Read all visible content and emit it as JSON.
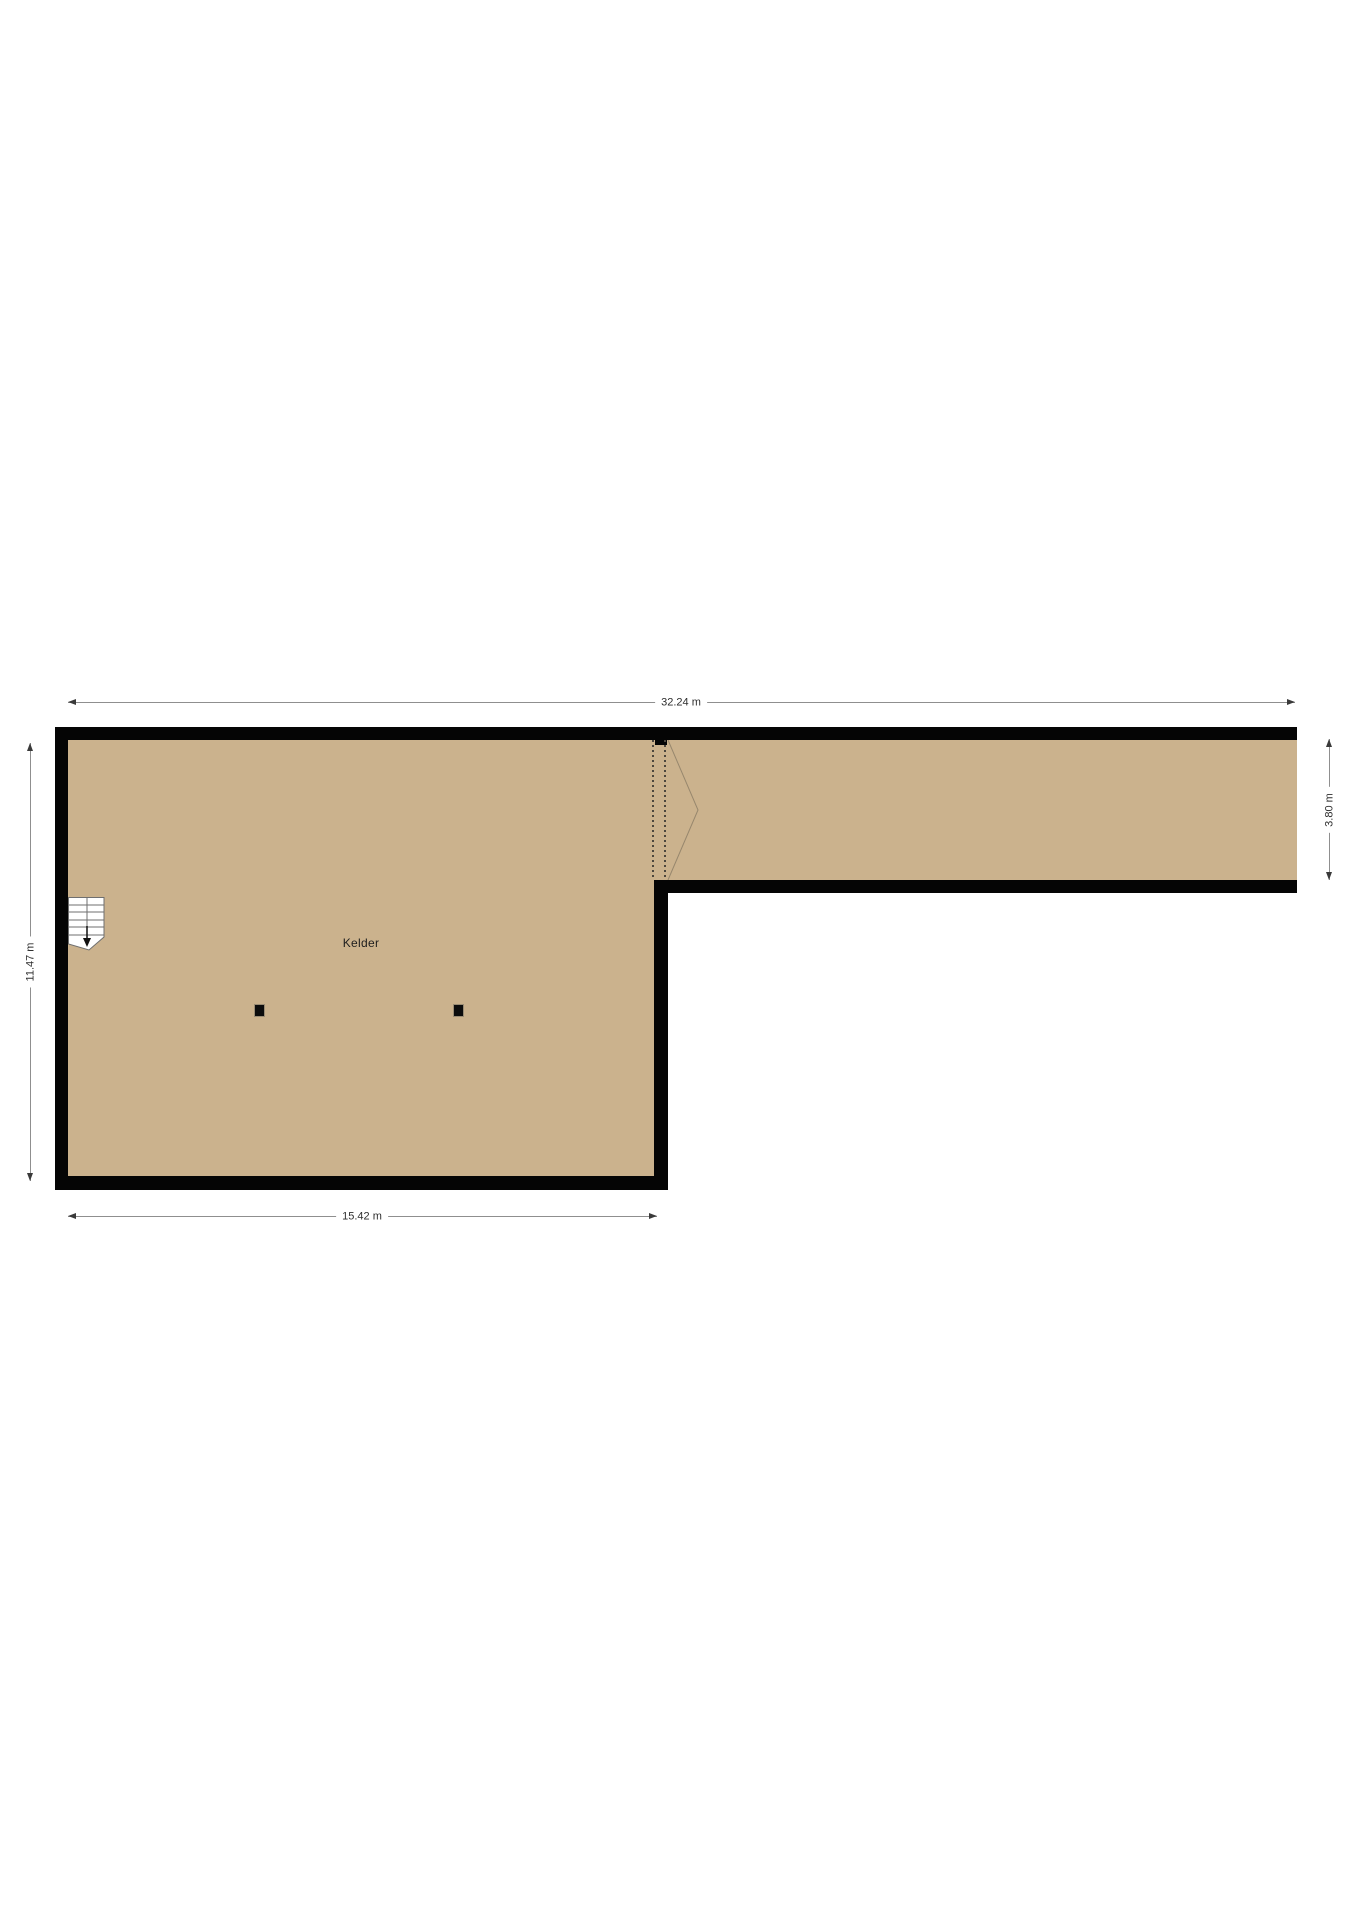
{
  "floorplan": {
    "room": {
      "label": "Kelder"
    },
    "dimensions": {
      "top": {
        "label": "32.24 m"
      },
      "left": {
        "label": "11.47 m"
      },
      "right": {
        "label": "3.80 m"
      },
      "bottom": {
        "label": "15.42 m"
      }
    },
    "icons": {
      "stairs_down_arrow": "▼"
    },
    "colors": {
      "floor_fill": "#cbb28d",
      "wall": "#050505",
      "dimension_line": "#8f8f8f",
      "dimension_text": "#2e2e2e",
      "opening_dash": "#4c463d",
      "opening_chevron": "#97876d"
    }
  }
}
